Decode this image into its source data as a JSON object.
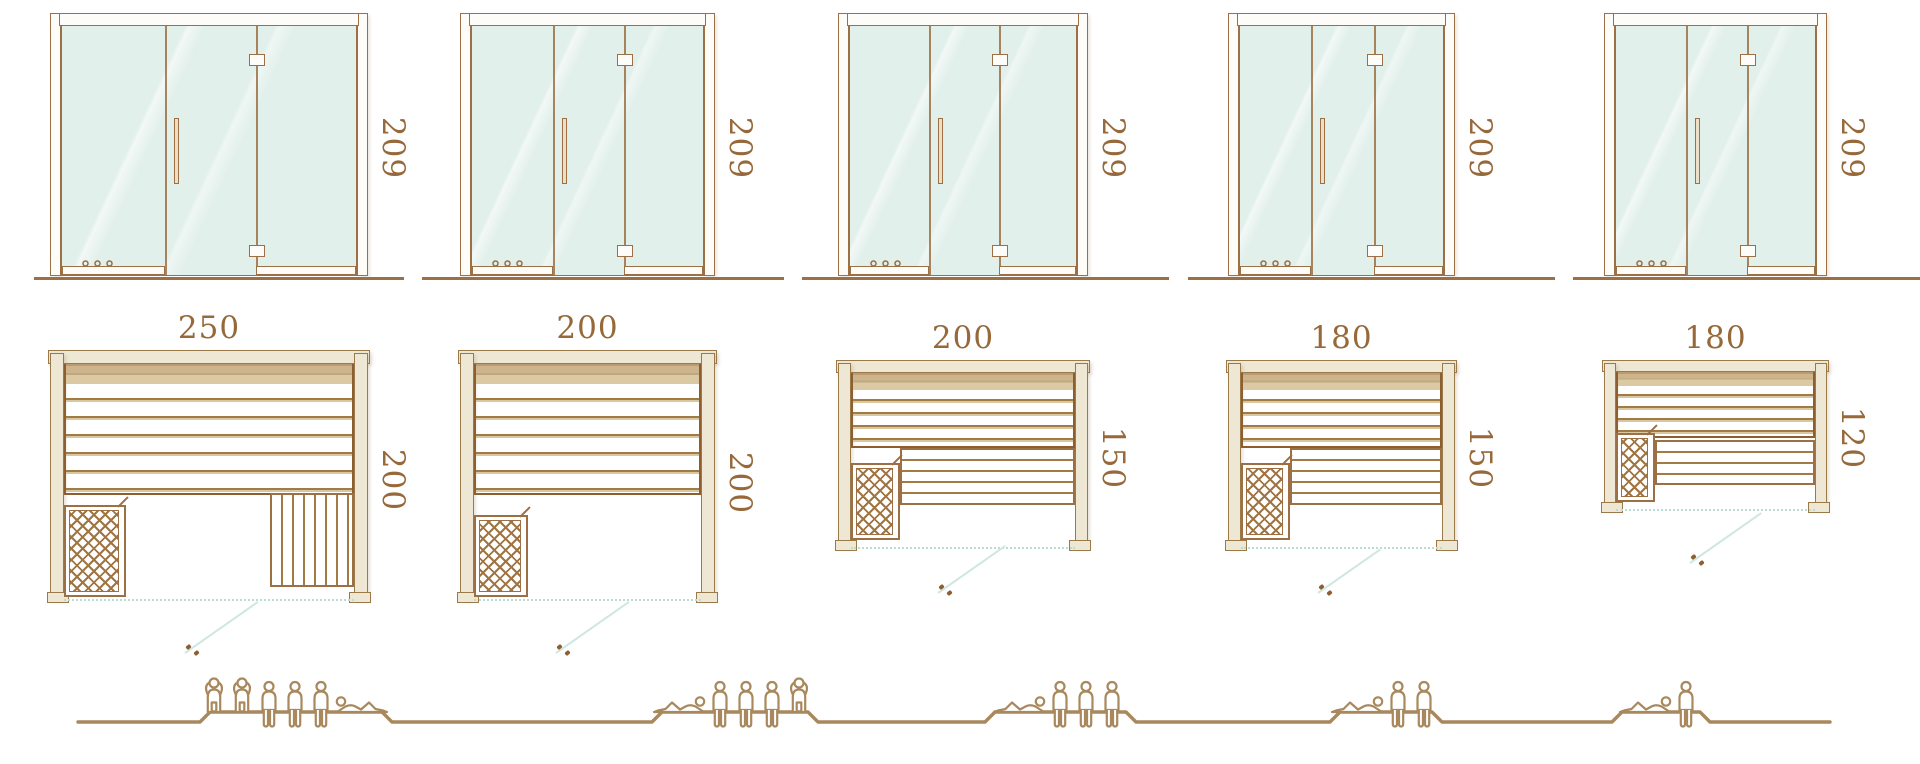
{
  "diagram": {
    "subject": "sauna-size-comparison",
    "units": "cm",
    "rows": [
      "door-front-elevation",
      "floor-plan",
      "seating-capacity"
    ]
  },
  "colors": {
    "line_brown": "#9c7044",
    "label_brown": "#96683a",
    "wall_fill": "#ede7d3",
    "glass_fill": "#e2f0ec",
    "swing_teal": "#cfe7e1",
    "people_brown": "#a8885c"
  },
  "variants": [
    {
      "name": "variant-1",
      "door_height": "209",
      "plan_width": "250",
      "plan_depth": "200",
      "capacity": 6,
      "people": [
        "standing",
        "standing",
        "sitting",
        "sitting",
        "sitting",
        "reclining"
      ]
    },
    {
      "name": "variant-2",
      "door_height": "209",
      "plan_width": "200",
      "plan_depth": "200",
      "capacity": 5,
      "people": [
        "reclining",
        "sitting",
        "sitting",
        "sitting",
        "standing"
      ]
    },
    {
      "name": "variant-3",
      "door_height": "209",
      "plan_width": "200",
      "plan_depth": "150",
      "capacity": 4,
      "people": [
        "reclining",
        "sitting",
        "sitting",
        "sitting"
      ]
    },
    {
      "name": "variant-4",
      "door_height": "209",
      "plan_width": "180",
      "plan_depth": "150",
      "capacity": 3,
      "people": [
        "reclining",
        "sitting",
        "sitting"
      ]
    },
    {
      "name": "variant-5",
      "door_height": "209",
      "plan_width": "180",
      "plan_depth": "120",
      "capacity": 2,
      "people": [
        "reclining",
        "sitting"
      ]
    }
  ]
}
